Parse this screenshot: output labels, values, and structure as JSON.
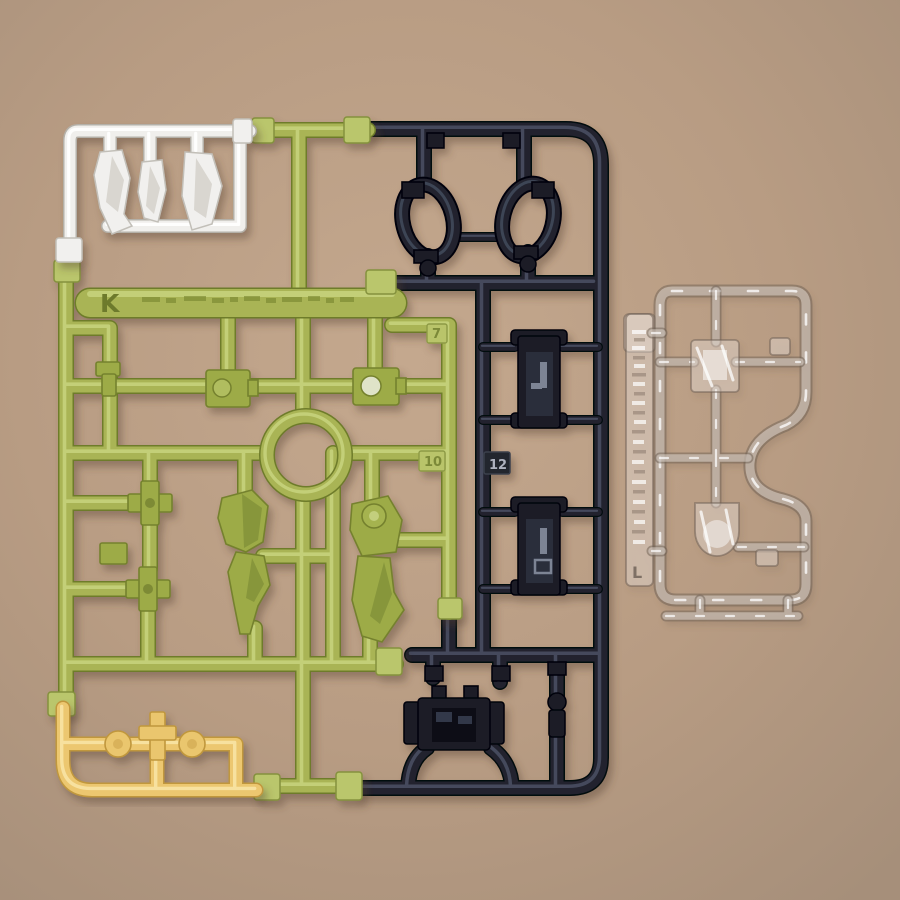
{
  "scene": {
    "type": "photograph",
    "subject": "Plastic model-kit runners (sprues) laid on a tan tabletop",
    "background_color": "#b69a82"
  },
  "sprues": {
    "green": {
      "gate_label": "K",
      "color": "#a9b454",
      "part_number_tags": [
        "7",
        "10"
      ],
      "embossed_text_illegible": true
    },
    "black": {
      "color": "#20242f",
      "part_number_tags": [
        "12"
      ]
    },
    "white": {
      "color": "#f0efec"
    },
    "yellow": {
      "color": "#ecc76f"
    },
    "clear": {
      "gate_label": "L",
      "color": "#e9e1d9",
      "embossed_text_illegible": true
    }
  },
  "labels": {
    "green_gate": "K",
    "tag_7": "7",
    "tag_10": "10",
    "tag_12": "12",
    "clear_gate": "L"
  }
}
